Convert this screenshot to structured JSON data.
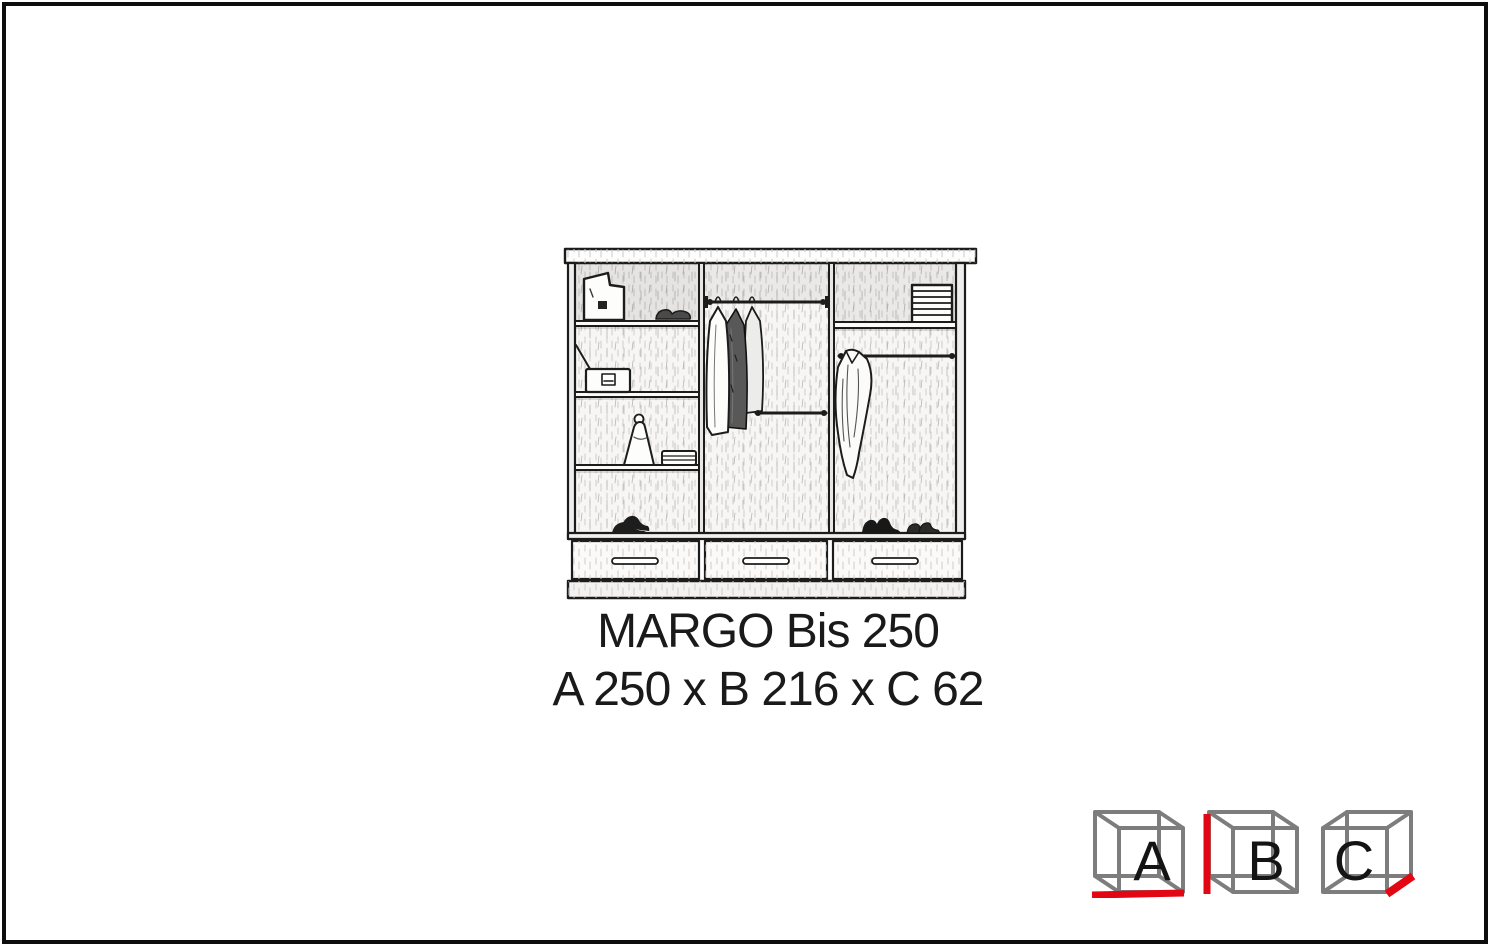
{
  "caption": {
    "title": "MARGO Bis 250",
    "dimensions": "A 250 x B 216 x C 62"
  },
  "dimension_icons": [
    {
      "label": "A",
      "icon": "cube-width-icon"
    },
    {
      "label": "B",
      "icon": "cube-height-icon"
    },
    {
      "label": "C",
      "icon": "cube-depth-icon"
    }
  ],
  "colors": {
    "accent_red": "#e30613",
    "cube_outline": "#7d7d7d",
    "ink": "#1a1a1a",
    "background": "#ffffff",
    "frame": "#0d0d0d"
  },
  "illustration": {
    "name": "wardrobe-interior-sketch"
  }
}
